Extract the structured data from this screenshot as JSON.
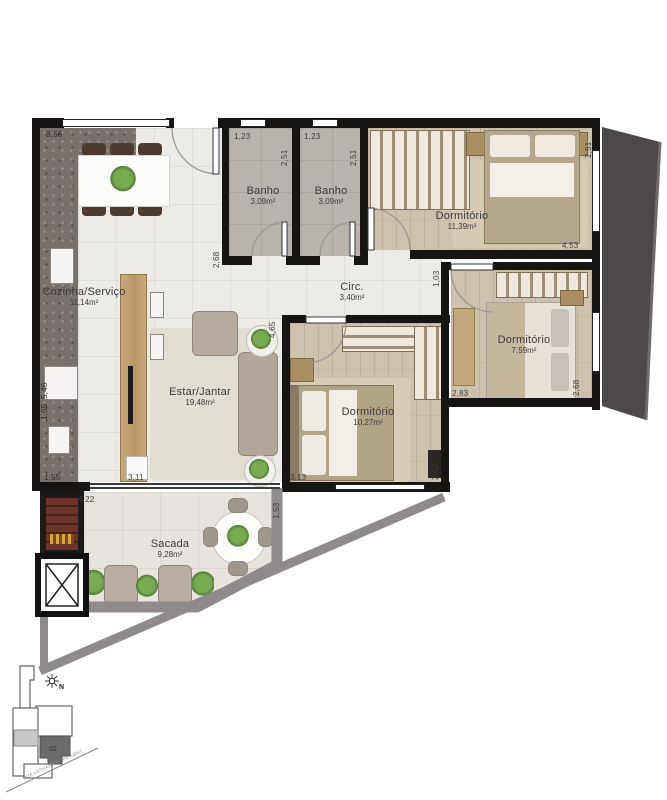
{
  "rooms": [
    {
      "name": "Cozinha/Serviço",
      "area": "11,14m²"
    },
    {
      "name": "Banho",
      "area": "3,09m²"
    },
    {
      "name": "Banho",
      "area": "3,09m²"
    },
    {
      "name": "Dormitório",
      "area": "11,39m²"
    },
    {
      "name": "Circ.",
      "area": "3,40m²"
    },
    {
      "name": "Estar/Jantar",
      "area": "19,48m²"
    },
    {
      "name": "Dormitório",
      "area": "10,27m²"
    },
    {
      "name": "Dormitório",
      "area": "7,59m²"
    },
    {
      "name": "Sacada",
      "area": "9,28m²"
    }
  ],
  "dimensions": [
    "3,56",
    "1,23",
    "1,23",
    "2,51",
    "2,51",
    "2,51",
    "2,68",
    "4,53",
    "1,03",
    "5,46",
    "1,65",
    "4,65",
    "1,55",
    "3,11",
    "3,13",
    "2,62",
    "2,83",
    "2,68",
    "4,22",
    "1,53"
  ],
  "keyplan": {
    "unit_label": "02",
    "street": "RUA LOTHAR FELIPE OBST"
  },
  "compass_label": "N",
  "colors": {
    "wall": "#171513",
    "wood_floor": "#cfc2ac",
    "granite": "#77706b",
    "neighbor_mass": "#4d484a",
    "site_line": "#8f8a8c",
    "brick": "#6c3429",
    "plant": "#5f9e49"
  }
}
